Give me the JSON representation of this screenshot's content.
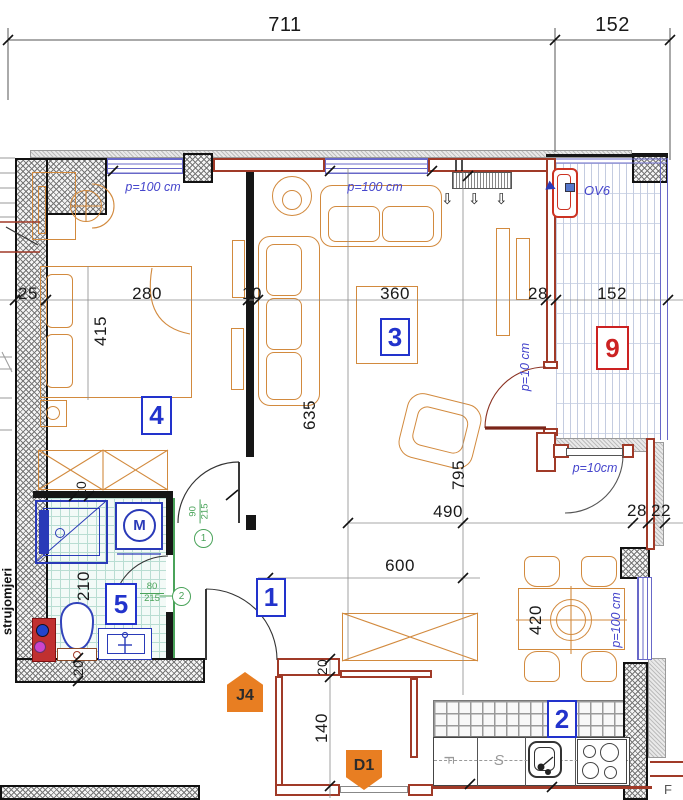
{
  "dims": {
    "top_main": "711",
    "top_right": "152",
    "w25": "25",
    "w280": "280",
    "w10": "10",
    "w360": "360",
    "w28": "28",
    "w152": "152",
    "h415": "415",
    "h635": "635",
    "h795": "795",
    "h210": "210",
    "h420": "420",
    "h140": "140",
    "w490": "490",
    "w600": "600",
    "r28": "28",
    "r22": "22",
    "b10": "10",
    "b20": "20",
    "hall20": "20"
  },
  "windows": {
    "top1": "p=100 cm",
    "top2": "p=100 cm",
    "right": "p=100 cm",
    "balcony_door": "p=10 cm",
    "side_door": "p=10cm"
  },
  "rooms": {
    "hall": "1",
    "kitchen": "2",
    "living": "3",
    "bedroom": "4",
    "bathroom": "5",
    "balcony": "9"
  },
  "markers": {
    "j4": "J4",
    "d1": "D1"
  },
  "door_tags": {
    "t1": {
      "n": "1",
      "a": "90",
      "b": "215"
    },
    "t2": {
      "n": "2",
      "a": "80",
      "b": "215"
    }
  },
  "texts": {
    "meter": "strujomjeri",
    "ov6": "OV6",
    "washer": "M",
    "counter_f": "F",
    "counter_s": "S",
    "neighbor_f": "F",
    "down_arrow": "⇩"
  },
  "colors": {
    "wall_red": "#a03a28",
    "fixture_blue": "#2a3ab8",
    "furniture_orange": "#d28a3e",
    "label_blue": "#2233cc",
    "label_red": "#cc2222",
    "tag_green": "#4aa35a",
    "marker_orange": "#e87e22",
    "window_blue": "#6868c8"
  }
}
